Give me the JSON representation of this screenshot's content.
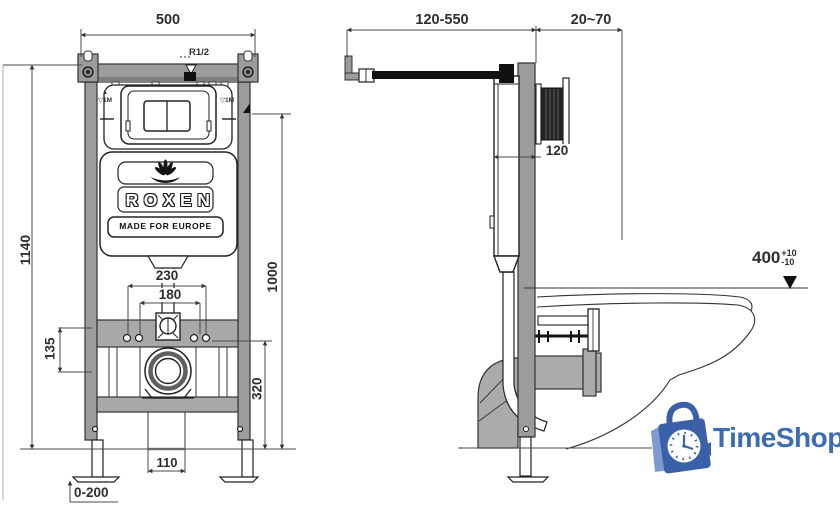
{
  "front_view": {
    "dim_width": "500",
    "dim_height": "1140",
    "thread_label": "R1/2",
    "datum_mark": "▲",
    "level_mark_left": "▽1M",
    "level_mark_right": "▽1M",
    "dim_bolt_outer": "230",
    "dim_bolt_inner": "180",
    "dim_bracket": "135",
    "dim_plate_height": "1000",
    "dim_drain_height": "320",
    "dim_outlet_spacing": "110",
    "dim_foot_adjust": "0-200",
    "logo_brand": "ROXEN",
    "logo_tagline": "MADE FOR EUROPE"
  },
  "side_view": {
    "dim_bracket_reach": "120-550",
    "dim_wall_offset": "20~70",
    "dim_frame_depth": "120",
    "dim_bowl_height": "400",
    "dim_bowl_tol_plus": "+10",
    "dim_bowl_tol_minus": "-10"
  },
  "watermark": {
    "brand": "TimeShop"
  },
  "colors": {
    "frame_gray": "#9c9c9c",
    "pipe_gray": "#ababab",
    "line_dark": "#222222",
    "dim_line": "#4a4a4a",
    "watermark_blue": "#3e6cb0",
    "watermark_blue_light": "#7d9bd1"
  }
}
